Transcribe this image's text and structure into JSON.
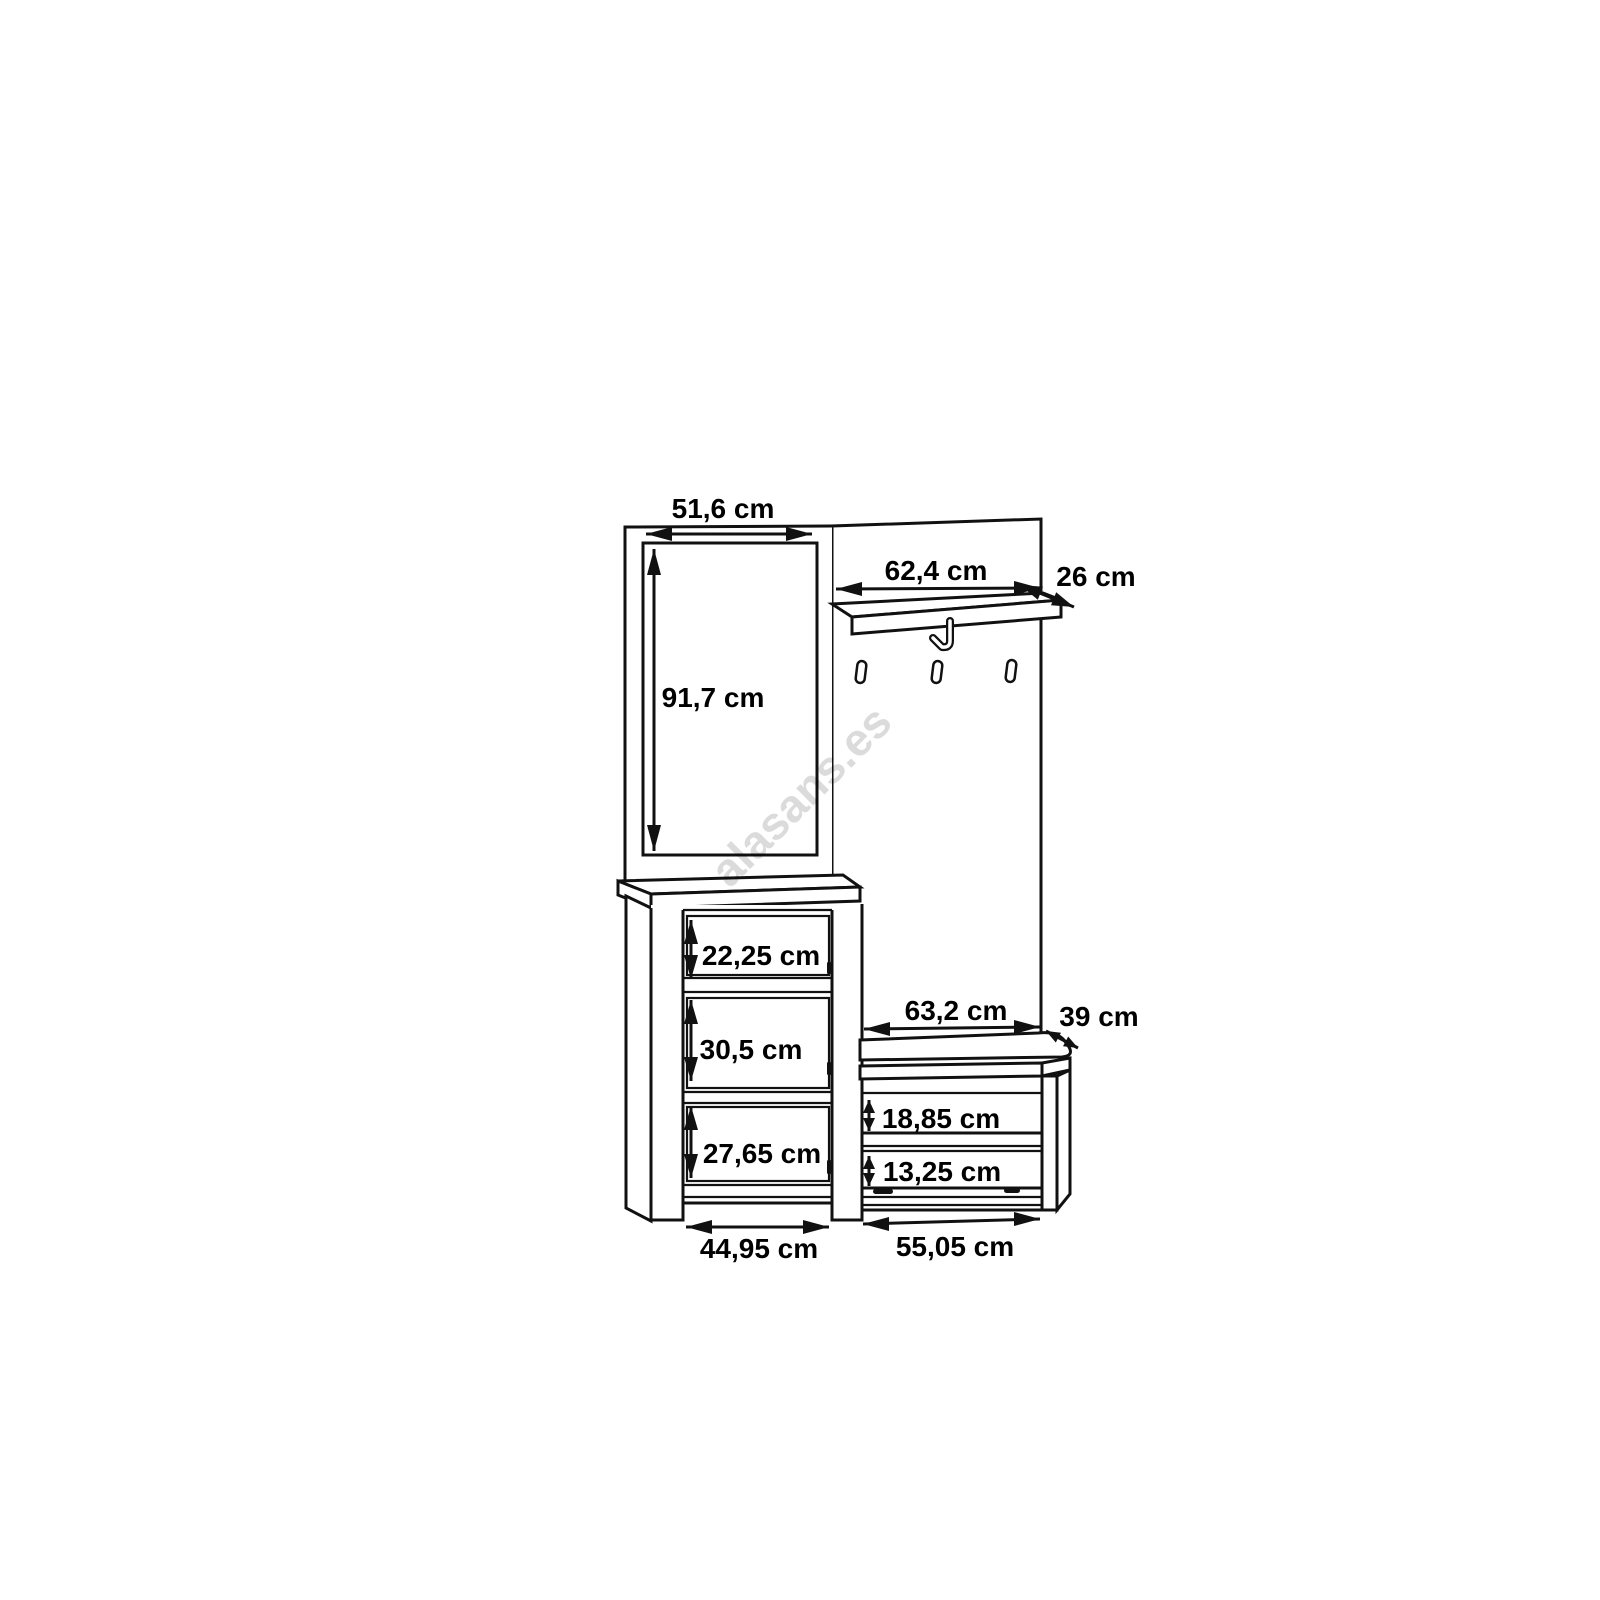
{
  "watermark_text": "alasans.es",
  "dimensions": {
    "mirror_width": "51,6 cm",
    "mirror_height": "91,7 cm",
    "coat_shelf_width": "62,4 cm",
    "coat_shelf_depth": "26 cm",
    "cabinet_top_compartment_height": "22,25 cm",
    "cabinet_middle_compartment_height": "30,5 cm",
    "cabinet_bottom_compartment_height": "27,65 cm",
    "bench_seat_width": "63,2 cm",
    "bench_seat_depth": "39 cm",
    "bench_upper_shelf_height": "18,85 cm",
    "bench_lower_shelf_height": "13,25 cm",
    "cabinet_bottom_width": "44,95 cm",
    "bench_bottom_width": "55,05 cm"
  }
}
